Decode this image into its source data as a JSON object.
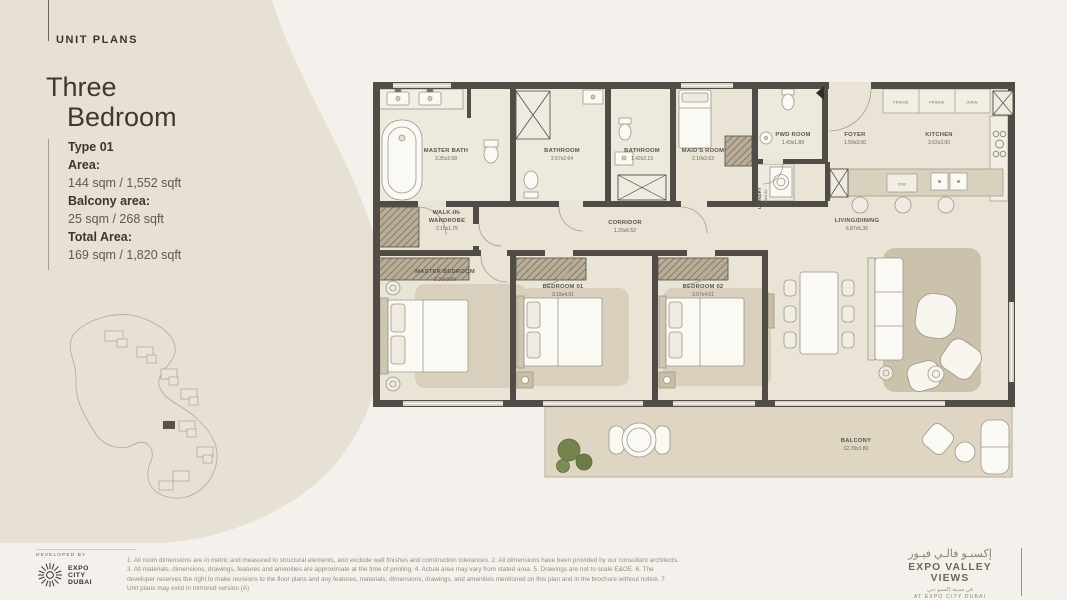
{
  "page": {
    "background": "#f4f1ec",
    "swoosh_color": "#e7e0d4",
    "wall_color": "#514d46"
  },
  "header": {
    "section_label": "UNIT PLANS"
  },
  "title": {
    "line1": "Three",
    "line2": "Bedroom"
  },
  "specs": {
    "type": "Type 01",
    "area_label": "Area:",
    "area_value": "144 sqm / 1,552 sqft",
    "balcony_label": "Balcony area:",
    "balcony_value": "25 sqm / 268 sqft",
    "total_label": "Total Area:",
    "total_value": "169 sqm / 1,820 sqft"
  },
  "floor_plan": {
    "rooms": {
      "master_bath": {
        "name": "MASTER BATH",
        "dims": "3.35x2.68"
      },
      "bathroom_a": {
        "name": "BATHROOM",
        "dims": "2.57x2.64"
      },
      "bathroom_b": {
        "name": "BATHROOM",
        "dims": "1.42x2.13"
      },
      "maids_room": {
        "name": "MAID'S ROOM",
        "dims": "2.10x2.63"
      },
      "pwd_room": {
        "name": "PWD ROOM",
        "dims": "1.43x1.89"
      },
      "laundry": {
        "name": "LAUNDRY",
        "dims": "1.00x0.80"
      },
      "foyer": {
        "name": "FOYER",
        "dims": "1.50x3.00"
      },
      "kitchen": {
        "name": "KITCHEN",
        "dims": "3.52x3.00"
      },
      "corridor": {
        "name": "CORRIDOR",
        "dims": "1.20x6.52"
      },
      "walk_in": {
        "line1": "WALK-IN-",
        "line2": "WARDROBE",
        "dims": "2.15x1.75"
      },
      "master_bedroom": {
        "name": "MASTER BEDROOM",
        "dims": "3.30x3.65"
      },
      "bedroom_01": {
        "name": "BEDROOM 01",
        "dims": "3.15x4.01"
      },
      "bedroom_02": {
        "name": "BEDROOM 02",
        "dims": "3.07x4.01"
      },
      "living_dining": {
        "name": "LIVING/DINING",
        "dims": "6.87x5.36"
      },
      "balcony": {
        "name": "BALCONY",
        "dims": "12.70x1.80"
      }
    },
    "appliances": {
      "fridge1": "FRIDGE",
      "fridge2": "FRIDGE",
      "oven": "OVEN",
      "dishwasher": "D/W"
    }
  },
  "footer": {
    "developed_by": "DEVELOPED BY",
    "developer_line1": "EXPO",
    "developer_line2": "CITY",
    "developer_line3": "DUBAI",
    "disclaimer": "1. All room dimensions are in metric and measured to structural elements, and exclude wall finishes and construction tolerances. 2. All dimensions have been provided by our consultant architects. 3. All materials, dimensions, drawings, features and amenities are approximate at the time of printing. 4. Actual area may vary from stated area. 5. Drawings are not to scale E&OE. 6. The developer reserves the right to make revisions to the floor plans and any features, materials, dimensions, drawings, and amenities mentioned on this plan and in the brochure without notice. 7. Unit plans may exist in mirrored version (A)",
    "brand_arabic": "إكسبـو فالـي فيـوز",
    "brand_name": "EXPO VALLEY VIEWS",
    "brand_sub_arabic": "في مدينة إكسبو دبي",
    "brand_sub": "AT EXPO CITY DUBAI"
  }
}
